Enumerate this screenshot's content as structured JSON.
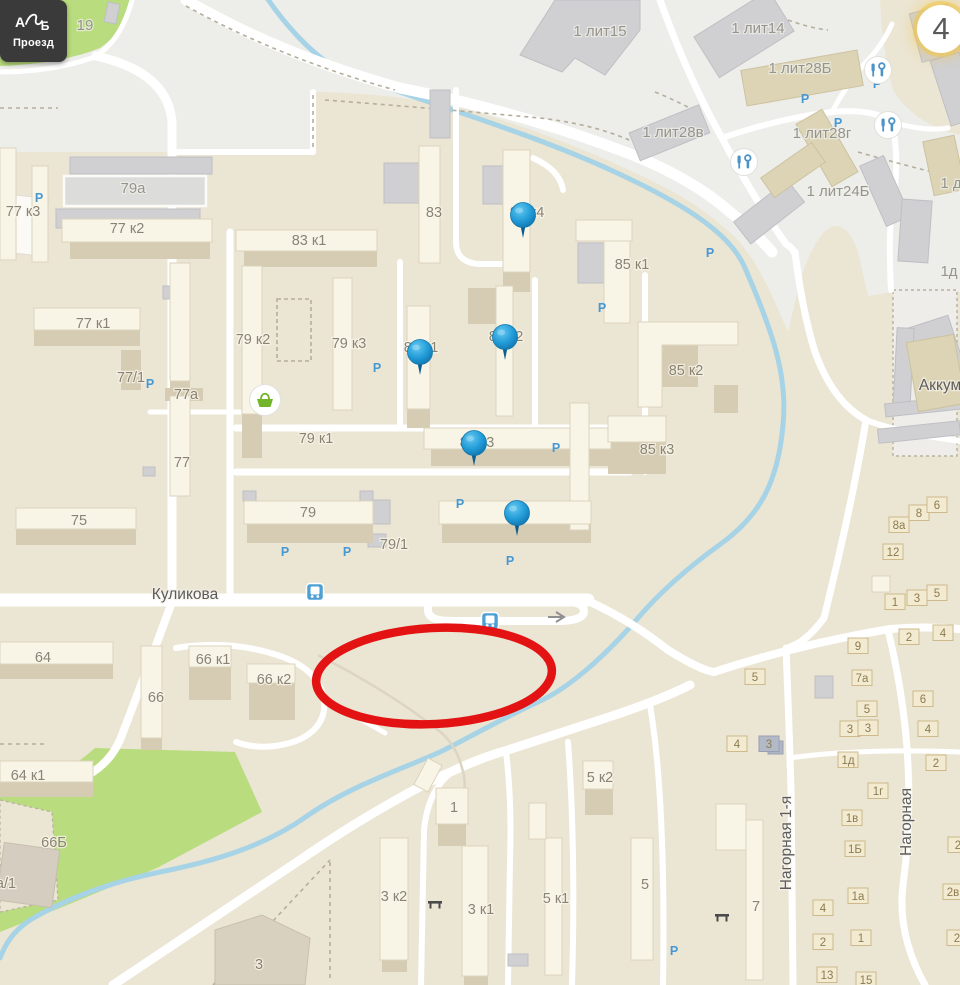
{
  "controls": {
    "route_button": {
      "from_label": "А",
      "to_label": "Б",
      "label": "Проезд"
    },
    "stop_badge": {
      "value": "4"
    }
  },
  "map": {
    "colors": {
      "ground": "#ebe5d3",
      "industrial_zone": "#ededea",
      "park": "#b9dc7e",
      "river": "#a7d3e6",
      "road": "#ffffff",
      "pin": "#1e94cc",
      "annotation": "#e31313",
      "parking": "#4598d4",
      "accent_badge": "#f0c64f"
    },
    "street_labels": [
      [
        "Куликова",
        185,
        599,
        0
      ],
      [
        "Нагорная 1-я",
        791,
        843,
        -90
      ],
      [
        "Нагорная",
        911,
        822,
        -90
      ],
      [
        "Аккум",
        940,
        390,
        0
      ]
    ],
    "area_labels": [
      [
        "1 лит15",
        600,
        36
      ],
      [
        "1 лит14",
        758,
        33
      ],
      [
        "1 лит28Б",
        800,
        73
      ],
      [
        "1 лит28в",
        673,
        137
      ],
      [
        "1 лит28г",
        822,
        138
      ],
      [
        "1 лит24Б",
        838,
        196
      ],
      [
        "1 д",
        951,
        188
      ],
      [
        "1д",
        949,
        276
      ],
      [
        "19",
        85,
        30
      ],
      [
        "79а",
        133,
        193
      ]
    ],
    "building_labels": [
      [
        "77 к3",
        23,
        216
      ],
      [
        "77 к2",
        127,
        233
      ],
      [
        "83 к1",
        309,
        245
      ],
      [
        "83",
        434,
        217
      ],
      [
        "83 к4",
        527,
        217
      ],
      [
        "85 к1",
        632,
        269
      ],
      [
        "77 к1",
        93,
        328
      ],
      [
        "79 к2",
        253,
        344
      ],
      [
        "79 к3",
        349,
        348
      ],
      [
        "83 к1",
        421,
        352
      ],
      [
        "83 к2",
        506,
        341
      ],
      [
        "77/1",
        131,
        382
      ],
      [
        "77а",
        186,
        399
      ],
      [
        "85 к2",
        686,
        375
      ],
      [
        "79 к1",
        316,
        443
      ],
      [
        "83 к3",
        477,
        447
      ],
      [
        "85 к3",
        657,
        454
      ],
      [
        "77",
        182,
        467
      ],
      [
        "75",
        79,
        525
      ],
      [
        "79",
        308,
        517
      ],
      [
        "79/1",
        394,
        549
      ],
      [
        "64",
        43,
        662
      ],
      [
        "66 к1",
        213,
        664
      ],
      [
        "66 к2",
        274,
        684
      ],
      [
        "66",
        156,
        702
      ],
      [
        "64 к1",
        28,
        780
      ],
      [
        "66Б",
        54,
        847
      ],
      [
        "а/1",
        6,
        888
      ],
      [
        "3",
        259,
        969
      ],
      [
        "3 к2",
        394,
        901
      ],
      [
        "1",
        454,
        812
      ],
      [
        "3 к1",
        481,
        914
      ],
      [
        "5 к1",
        556,
        903
      ],
      [
        "5 к2",
        600,
        782
      ],
      [
        "5",
        645,
        889
      ],
      [
        "7",
        756,
        911
      ]
    ],
    "house_numbers": [
      [
        "8а",
        899,
        529
      ],
      [
        "8",
        919,
        517
      ],
      [
        "6",
        937,
        509
      ],
      [
        "12",
        893,
        556
      ],
      [
        "1",
        895,
        606
      ],
      [
        "3",
        917,
        602
      ],
      [
        "5",
        937,
        597
      ],
      [
        "9",
        858,
        650
      ],
      [
        "2",
        909,
        641
      ],
      [
        "4",
        943,
        637
      ],
      [
        "5",
        755,
        681
      ],
      [
        "7а",
        862,
        682
      ],
      [
        "6",
        923,
        703
      ],
      [
        "5",
        867,
        713
      ],
      [
        "3",
        850,
        733
      ],
      [
        "3",
        868,
        732
      ],
      [
        "4",
        928,
        733
      ],
      [
        "4",
        737,
        748
      ],
      [
        "3",
        769,
        748,
        "gray"
      ],
      [
        "1д",
        848,
        764
      ],
      [
        "2",
        936,
        767
      ],
      [
        "1г",
        878,
        795
      ],
      [
        "1в",
        852,
        822
      ],
      [
        "1Б",
        855,
        853
      ],
      [
        "1а",
        858,
        900
      ],
      [
        "4",
        823,
        912
      ],
      [
        "1",
        861,
        942
      ],
      [
        "2",
        823,
        946
      ],
      [
        "13",
        827,
        979
      ],
      [
        "15",
        866,
        984
      ],
      [
        "2в",
        953,
        896
      ],
      [
        "2",
        958,
        849
      ],
      [
        "2",
        957,
        942
      ]
    ],
    "parking_markers": [
      [
        39,
        202
      ],
      [
        150,
        388
      ],
      [
        377,
        372
      ],
      [
        285,
        556
      ],
      [
        347,
        556
      ],
      [
        460,
        508
      ],
      [
        510,
        565
      ],
      [
        556,
        452
      ],
      [
        602,
        312
      ],
      [
        674,
        955
      ],
      [
        805,
        103
      ],
      [
        838,
        127
      ],
      [
        877,
        88
      ],
      [
        710,
        257
      ]
    ],
    "pins": [
      [
        523,
        215
      ],
      [
        420,
        352
      ],
      [
        505,
        337
      ],
      [
        474,
        443
      ],
      [
        517,
        513
      ]
    ],
    "poi": {
      "grocery": [
        [
          265,
          400
        ]
      ],
      "car_service": [
        [
          878,
          70
        ],
        [
          888,
          125
        ],
        [
          744,
          162
        ]
      ],
      "bus_stop": [
        [
          315,
          592
        ],
        [
          490,
          621
        ]
      ],
      "bench": [
        [
          435,
          904
        ],
        [
          722,
          917
        ]
      ]
    },
    "annotation": {
      "shape": "ellipse",
      "cx": 434,
      "cy": 676,
      "rx": 118,
      "ry": 48,
      "rotation": -3,
      "stroke_width": 8.5
    }
  }
}
